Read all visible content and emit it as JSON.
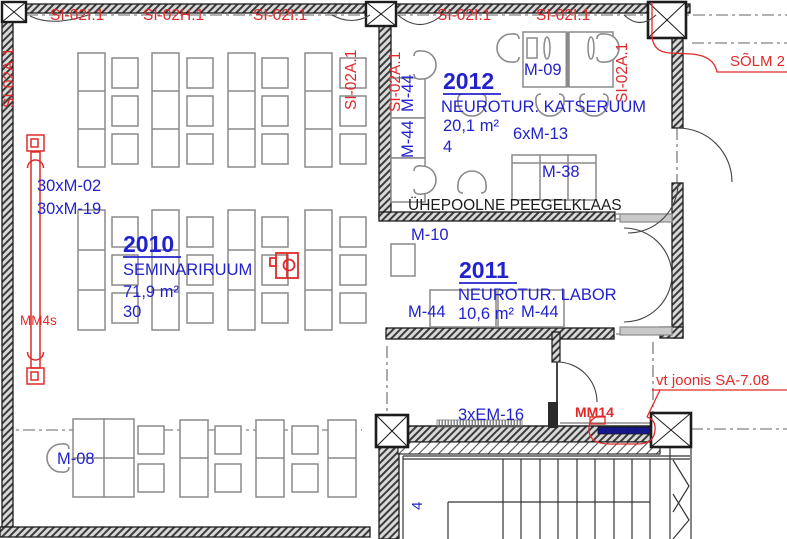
{
  "colors": {
    "label_blue": "#2222cc",
    "annotation_red": "#e02a2a",
    "wall_black": "#1c1c1c",
    "furniture_gray": "#8a8a8a",
    "mm14_bar_navy": "#17178c"
  },
  "grid": {
    "top_labels": [
      "SI-02I.1",
      "SI-02H.1",
      "SI-02I.1",
      "SI-02I.1",
      "SI-02I.1"
    ],
    "vertical_labels": [
      "SI-02A.1",
      "SI-02A.1",
      "SI-02A.1",
      "SI-02A.1"
    ],
    "solm_label": "SÕLM 2"
  },
  "room_2010": {
    "number": "2010",
    "name": "SEMINARIRUUM",
    "area": "71,9 m²",
    "seats": "30",
    "note_1": "30xM-02",
    "note_2": "30xM-19"
  },
  "room_2012": {
    "number": "2012",
    "name": "NEUROTUR. KATSERUUM",
    "area": "20,1 m²",
    "seats": "4",
    "desk_label": "M-09",
    "chairs_label": "6xM-13",
    "sofa_label": "M-38",
    "wall_table_label_1": "M-44",
    "wall_table_label_2": "M-44"
  },
  "room_2011": {
    "number": "2011",
    "name": "NEUROTUR. LABOR",
    "area": "10,6 m²",
    "cabinet_label": "M-10",
    "table_label_1": "M-44",
    "table_label_2": "M-44"
  },
  "annotations": {
    "mirror_glass_note": "ÜHEPOOLNE PEEGELKLAAS",
    "radiator_label": "MM4s",
    "chair_label": "M-08",
    "convector_label": "3xEM-16",
    "mm14_label": "MM14",
    "detail_reference": "vt joonis SA-7.08",
    "stair_label": "4"
  }
}
